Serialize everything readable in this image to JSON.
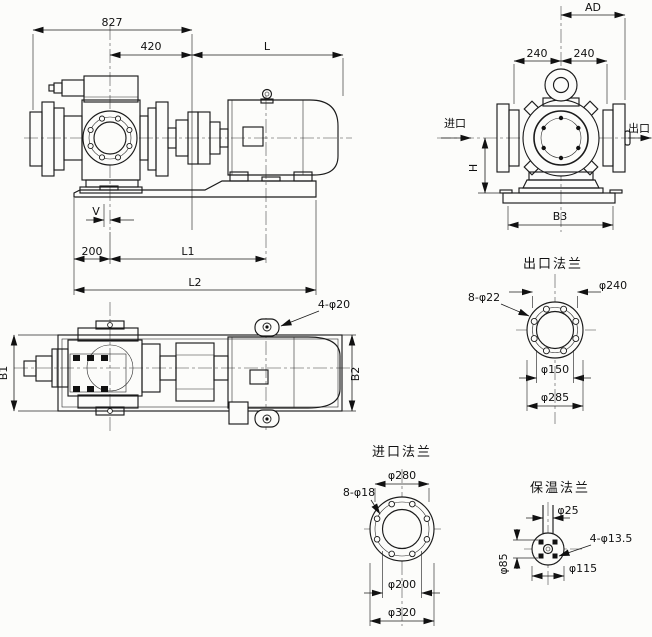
{
  "side_view": {
    "dims": {
      "overall": "827",
      "front": "420",
      "l": "L",
      "v": "V",
      "left": "200",
      "l1": "L1",
      "l2": "L2"
    }
  },
  "plan_view": {
    "dims": {
      "b1": "B1",
      "b2": "B2"
    },
    "labels": {
      "lug_holes": "4-φ20"
    }
  },
  "end_view": {
    "dims": {
      "ad": "AD",
      "half_left": "240",
      "half_right": "240",
      "h": "H",
      "b3": "B3"
    },
    "labels": {
      "inlet": "进口",
      "outlet": "出口"
    }
  },
  "flanges": {
    "outlet": {
      "title": "出口法兰",
      "labels": {
        "bolt_circle": "φ240",
        "holes": "8-φ22",
        "bore": "φ150",
        "od": "φ285"
      }
    },
    "inlet": {
      "title": "进口法兰",
      "labels": {
        "bolt_circle": "φ280",
        "holes": "8-φ18",
        "bore": "φ200",
        "od": "φ320"
      }
    },
    "insulation": {
      "title": "保温法兰",
      "labels": {
        "pipe": "φ25",
        "holes": "4-φ13.5",
        "bolt_span": "φ85",
        "od": "φ115"
      }
    }
  }
}
